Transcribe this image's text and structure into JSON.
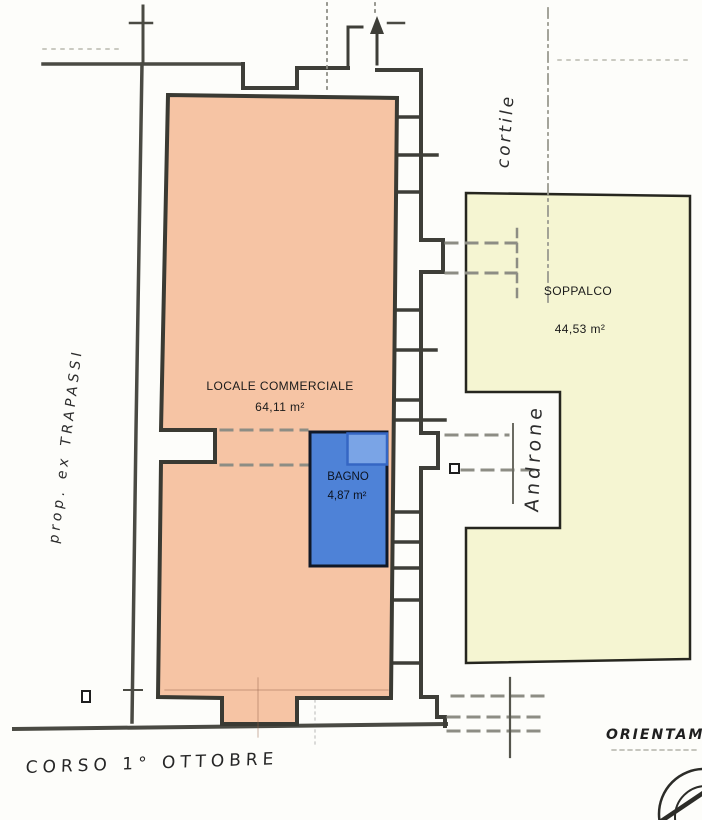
{
  "rooms": {
    "locale": {
      "label": "LOCALE COMMERCIALE",
      "area": "64,11 m²"
    },
    "bagno": {
      "label": "BAGNO",
      "area": "4,87 m²"
    },
    "soppalco": {
      "label": "SOPPALCO",
      "area": "44,53 m²"
    }
  },
  "annotations": {
    "courtyard": "cortile",
    "hallway": "Androne",
    "property": "prop. ex TRAPASSI",
    "street": "CORSO 1° OTTOBRE",
    "orientation": "ORIENTAME"
  },
  "colors": {
    "locale_fill": "#f6c4a4",
    "bagno_fill": "#4e82d7",
    "bagno_shower_fill": "#7aa4e6",
    "soppalco_fill": "#f5f5d2",
    "wall": "#3e3e38"
  }
}
